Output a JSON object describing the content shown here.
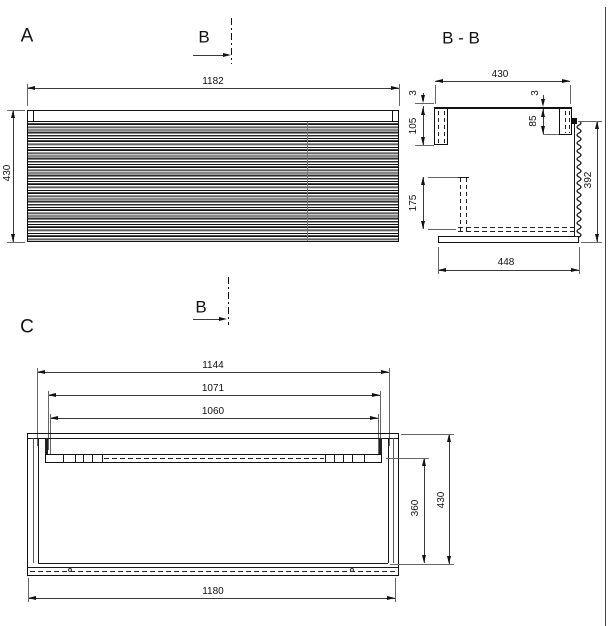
{
  "drawing": {
    "labels": {
      "view_a": "A",
      "view_c": "C",
      "section_title": "B - B",
      "cut_marker": "B"
    },
    "front_view": {
      "width": "1182",
      "height": "430"
    },
    "section_view": {
      "top_width": "430",
      "gap_left": "3",
      "back_rail_height": "105",
      "gap_right": "3",
      "front_rail_height": "85",
      "slide_height": "175",
      "inner_depth": "392",
      "bottom_depth": "448"
    },
    "bottom_view": {
      "outer_width": "1144",
      "rail_width_outer": "1071",
      "rail_width_inner": "1060",
      "inner_depth": "360",
      "outer_depth": "430",
      "body_width": "1180"
    },
    "colors": {
      "line": "#1a1a1a",
      "background": "#ffffff"
    }
  }
}
